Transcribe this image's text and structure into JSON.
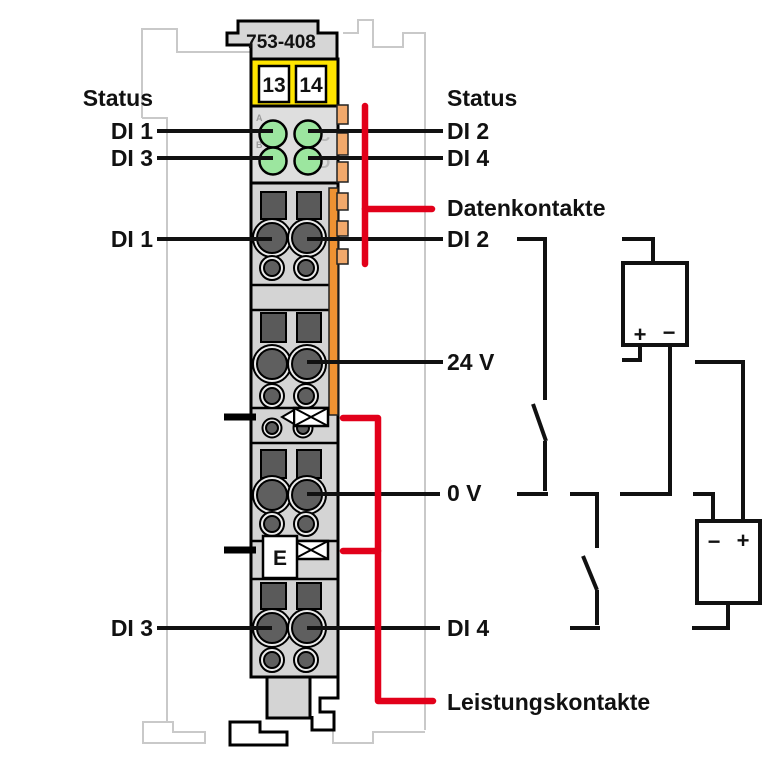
{
  "diagram_title": "WAGO 753-408 4-channel digital input wiring diagram",
  "colors": {
    "callout_red": "#e2001a",
    "terminal_yellow": "#ffe500",
    "led_green": "#9ce69f",
    "data_contact_strip_orange": "#ef9232",
    "data_contact_tab_orange": "#f2a96b",
    "module_gray": "#d4d4d4",
    "outline_black": "#000000",
    "background_outline_gray": "#c9c9c9"
  },
  "module": {
    "part_number": "753-408",
    "terminals": [
      "13",
      "14"
    ],
    "marking": "E",
    "led_letters": [
      "A",
      "B",
      "C",
      "D"
    ]
  },
  "labels_left": {
    "status": "Status",
    "di1_led": "DI 1",
    "di3_led": "DI 3",
    "di1_term": "DI 1",
    "di3_term": "DI 3"
  },
  "labels_right": {
    "status": "Status",
    "di2_led": "DI 2",
    "di4_led": "DI 4",
    "datenkontakte": "Datenkontakte",
    "di2_term": "DI 2",
    "v24": "24 V",
    "v0": "0 V",
    "di4_term": "DI 4",
    "leistungskontakte": "Leistungskontakte"
  },
  "circuit": {
    "psu_top": {
      "plus": "+",
      "minus": "−"
    },
    "psu_bottom": {
      "minus": "−",
      "plus": "+"
    }
  }
}
